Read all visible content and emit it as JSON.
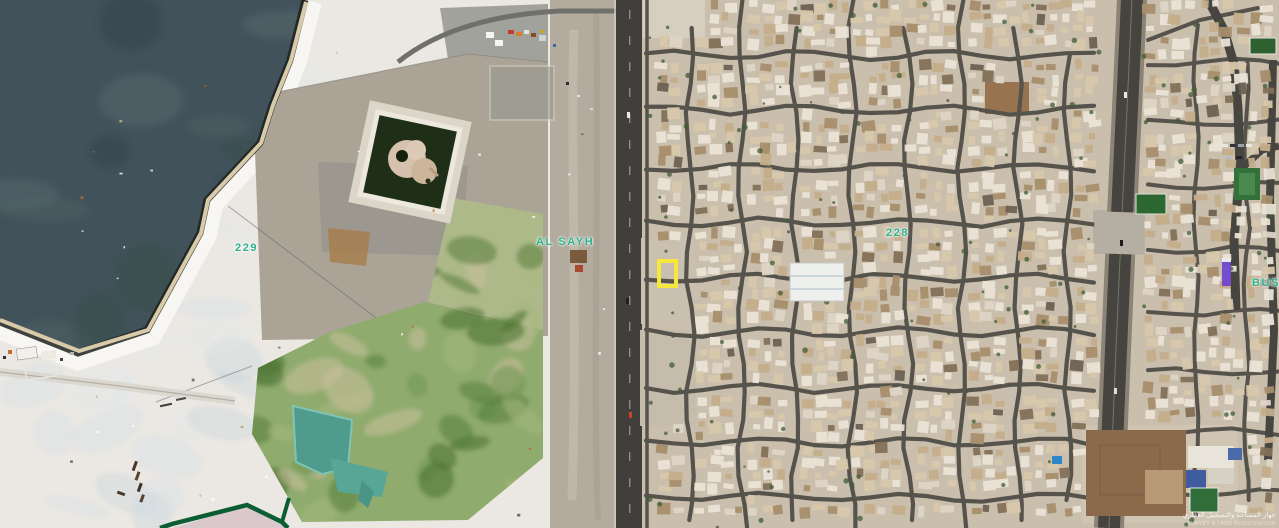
{
  "app": {
    "name": "satellite map viewer",
    "view": "aerial imagery"
  },
  "map": {
    "imagery_type": "satellite",
    "labels": [
      {
        "id": "block-229",
        "text": "229",
        "x": 235,
        "y": 242
      },
      {
        "id": "district-al-sayh",
        "text": "AL SAYH",
        "x": 536,
        "y": 236
      },
      {
        "id": "block-228",
        "text": "228",
        "x": 886,
        "y": 227
      },
      {
        "id": "district-bus",
        "text": "BUS",
        "x": 1252,
        "y": 277
      }
    ],
    "marker": {
      "shape": "rectangle",
      "x": 657,
      "y": 259,
      "width": 21,
      "height": 29
    },
    "boundary": {
      "fill": "#dbc8cd",
      "stroke": "#0b5e33"
    },
    "watermark": {
      "line1": "جهاز المساحة والتسجيل العقاري",
      "line2": "SURVEY & LAND REGISTRATION"
    },
    "colors": {
      "label": "#2eb18e",
      "marker": "#f6e73c",
      "boundary": "#0b5e33",
      "water": "#41525a",
      "sand": "#f2f1ee",
      "urban_base": "#cabead",
      "street": "#55534c",
      "highway": "#3d3c38",
      "vegetation": "#8fab6d",
      "pond": "#53a092"
    }
  }
}
